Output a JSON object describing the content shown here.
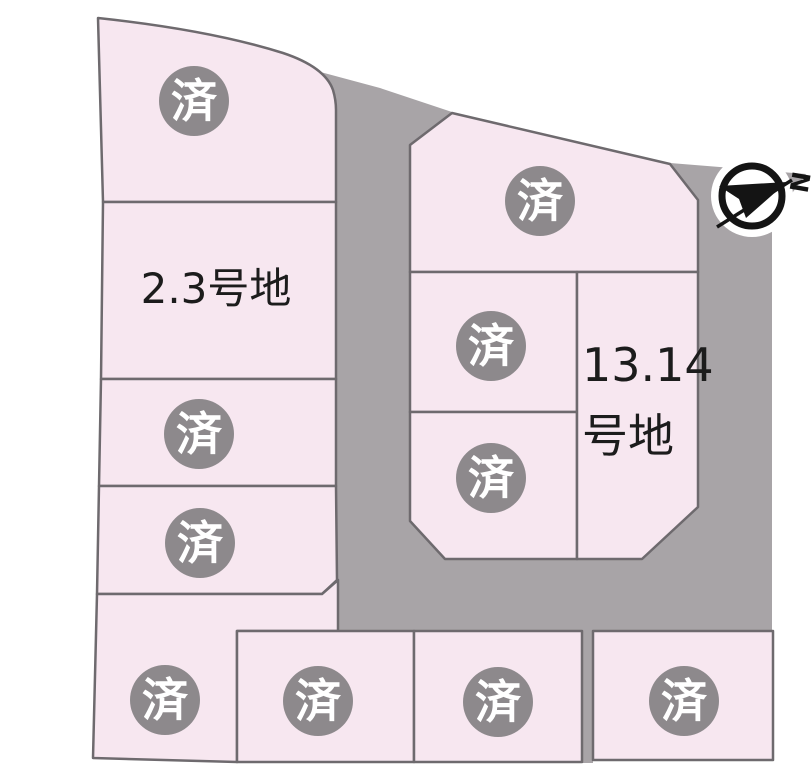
{
  "map": {
    "description": "housing-lot-subdivision-map",
    "sold_label": "済",
    "sold_lot_count": 10,
    "labels": {
      "lot_2_3": "2.3号地",
      "lot_13_14_line1": "13.14",
      "lot_13_14_line2": "号地"
    },
    "compass": {
      "north_label": "N"
    },
    "colors": {
      "lot_fill": "#f7e7f0",
      "road_fill": "#a8a4a7",
      "sold_badge_fill": "#8d898c",
      "sold_badge_text": "#ffffff",
      "lot_border": "#6e6a6e",
      "label_text": "#1c1c1c",
      "compass_ink": "#141414",
      "page_background": "#ffffff"
    }
  }
}
